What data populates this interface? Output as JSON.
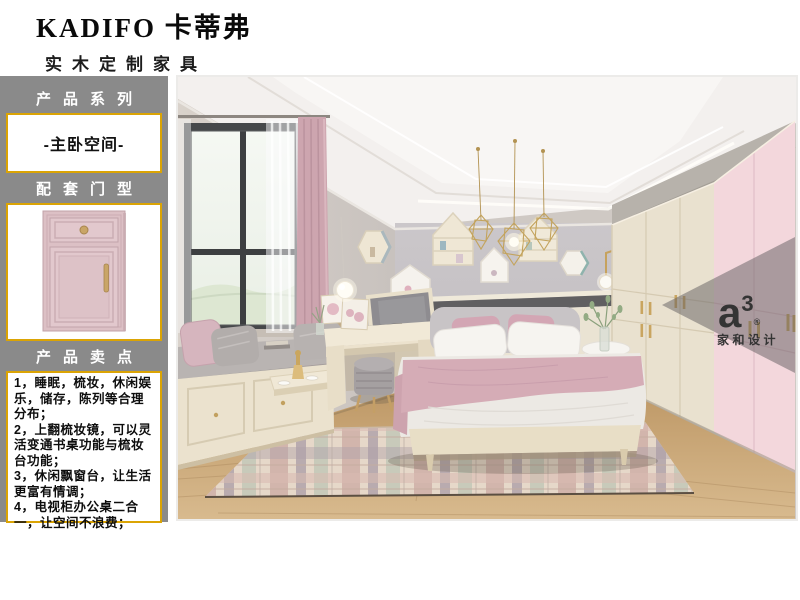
{
  "header": {
    "brand": "KADIFO 卡蒂弗",
    "subtitle": "实木定制家具"
  },
  "sidebar": {
    "series_title": "产品系列",
    "series_value": "-主卧空间-",
    "door_title": "配套门型",
    "points_title": "产品卖点",
    "points": [
      "1，睡眠，梳妆，休闲娱乐，储存，陈列等合理分布；",
      "2，上翻梳妆镜，可以灵活变通书桌功能与梳妆台功能；",
      "3，休闲飘窗台，让生活更富有情调；",
      "4，电视柜办公桌二合一，让空间不浪费；"
    ]
  },
  "watermark": {
    "logo_letter": "a",
    "logo_sup": "3",
    "logo_reg": "®",
    "studio": "家和设计"
  },
  "colors": {
    "sidebar_bg": "#8a8a8a",
    "accent_gold": "#dba404",
    "door_pink": "#dcc0c5",
    "wardrobe_cream": "#e9e1cf",
    "wardrobe_pink": "#f3d7dc",
    "wall_gray": "#c6c2c5",
    "blanket_pink": "#d5acb6",
    "floor_wood": "#c9a473"
  }
}
